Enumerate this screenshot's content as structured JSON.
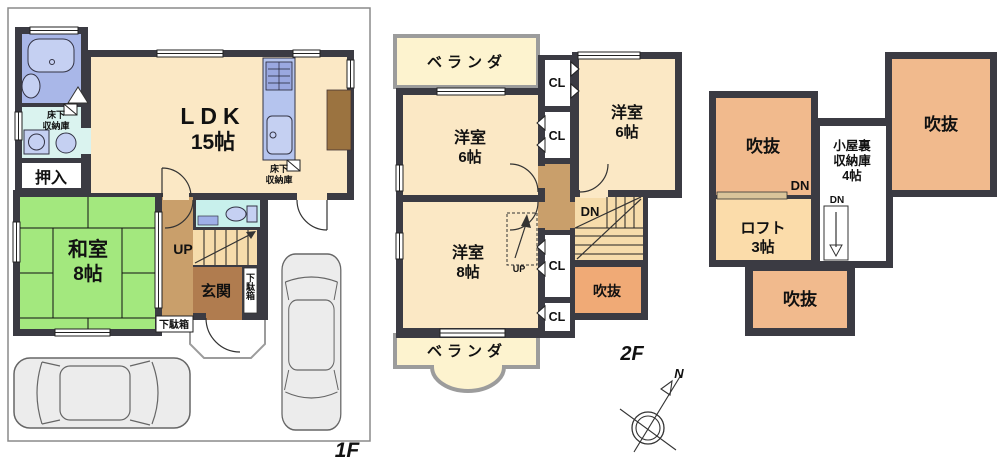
{
  "colors": {
    "wall": "#3b3b43",
    "cream": "#fbe8c5",
    "tatami": "#a3e87e",
    "bath": "#a9b7e8",
    "washroom": "#daf3ef",
    "toilet": "#c8f0ec",
    "hall": "#c99f6b",
    "genkan": "#b07c4f",
    "stairs": "#f6dcab",
    "void2f": "#f0aa76",
    "voidloft": "#f1ba8d",
    "loft": "#fbdcaa",
    "veranda": "#fdf3cf",
    "verandaedge": "#9c9c9c",
    "kitchen": "#b5c4ee",
    "fixture": "#c5d0f2",
    "counter": "#9b7340",
    "car": "#ececec"
  },
  "floor1": {
    "floor_label": "1F",
    "ldk_label": [
      "LDK",
      "15帖"
    ],
    "washitsu_label": [
      "和室",
      "8帖"
    ],
    "oshiire_label": "押入",
    "genkan_label": "玄関",
    "underfloor_storage_label_a": [
      "床下",
      "収納庫"
    ],
    "underfloor_storage_label_b": [
      "床下",
      "収納庫"
    ],
    "shoe_cabinet_label_a": "下駄箱",
    "shoe_cabinet_label_b": "下駄箱",
    "stairs_up_label": "UP"
  },
  "floor2": {
    "floor_label": "2F",
    "veranda_top_label": "ベランダ",
    "veranda_bottom_label": "ベランダ",
    "bedroom6_left_label": [
      "洋室",
      "6帖"
    ],
    "bedroom6_right_label": [
      "洋室",
      "6帖"
    ],
    "bedroom8_label": [
      "洋室",
      "8帖"
    ],
    "closet_labels": [
      "CL",
      "CL",
      "CL",
      "CL"
    ],
    "stairs_down_label": "DN",
    "loft_ladder_up_label": "UP",
    "void_label": "吹抜",
    "compass_north_label": "N"
  },
  "loft": {
    "void_left_label": "吹抜",
    "void_right_label": "吹抜",
    "void_bottom_label": "吹抜",
    "loft_label": [
      "ロフト",
      "3帖"
    ],
    "attic_storage_label": [
      "小屋裏",
      "収納庫",
      "4帖"
    ],
    "loft_ladder_down_label": "DN",
    "attic_ladder_down_label": "DN"
  }
}
